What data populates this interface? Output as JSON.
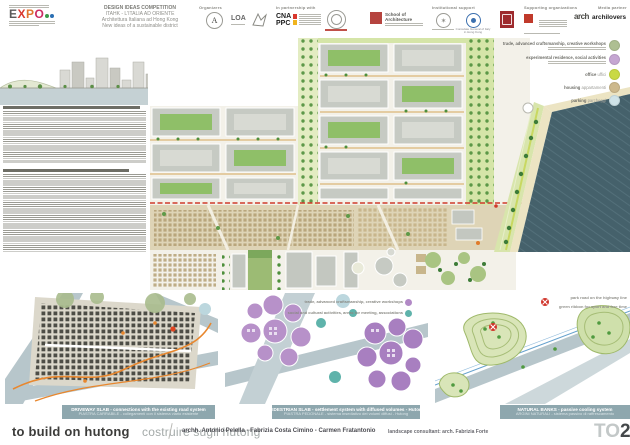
{
  "poster": {
    "header": {
      "expo_logo_text": "EXPO",
      "title_lines": [
        "DESIGN IDEAS COMPETITION",
        "ITAHK - L'ITALIA AD ORIENTE",
        "Architettura Italiana ad Hong Kong",
        "New ideas of a sustainable district"
      ],
      "organizers_label": "Organizers",
      "organizer_a": "A",
      "organizer_loa": "LOA",
      "partnership_label": "In partnership with",
      "cna_line1": "CNA",
      "cna_line2": "PPC",
      "school_logo": "School of Architecture",
      "institutional_label": "Institutional support",
      "consulate_caption_1": "Consulate General of Italy",
      "consulate_caption_2": "in Hong Kong",
      "supporting_label": "Supporting organizations",
      "arch_logo": "arch",
      "media_label": "Media partner",
      "media_logo": "archilovers"
    },
    "legend": {
      "items": [
        {
          "label": "trade, advanced craftsmanship, creative workshops",
          "color": "#aebf92"
        },
        {
          "label": "experimental residence, social activities",
          "color": "#c5a6d2"
        },
        {
          "label": "office",
          "sublabel": "uffici",
          "color": "#c9d944"
        },
        {
          "label": "housing",
          "sublabel": "appartamenti",
          "color": "#cdb98d"
        },
        {
          "label": "parking",
          "sublabel": "parcheggi",
          "color": "#cfe3e8"
        }
      ]
    },
    "diagram_legend": {
      "items": [
        {
          "label": "trade, advanced craftsmanship, creative workshops",
          "color": "#b289c6"
        },
        {
          "label": "social and cultural activities, areas for meeting, associations",
          "color": "#5fb3ab"
        }
      ]
    },
    "natural_banks_notes": {
      "note1": "park road on the highway line",
      "note2": "green ribbon for sport and free time"
    },
    "captions": [
      {
        "en": "DRIVEWAY SLAB - connections with the existing road system",
        "it": "PIASTRA CARRABILE - collegamenti con il sistema viario esistente"
      },
      {
        "en": "PEDESTRIAN SLAB - settlement system with diffused volumes - Hutong",
        "it": "PIASTRA PEDONALE - sistema insediativo dei volumi diffusi - Hutong"
      },
      {
        "en": "NATURAL BANKS - passive cooling system",
        "it": "ARGINI NATURALI - sistema passivo di raffrescamento"
      }
    ],
    "footer": {
      "title_en": "to build on hutong",
      "title_it": "costruire sugli hutong",
      "architects": "archh. Antonio Pelella - Fabrizia Costa Cimino - Carmen Fratantonio",
      "consultant": "landscape consultant: arch. Fabrizia Forte",
      "logo_to": "TO",
      "logo_2": "2"
    },
    "colors": {
      "water": "#45616b",
      "park_green": "#8fbf68",
      "tree_green": "#4e8f3c",
      "block_gray": "#c6cac3",
      "hutong_tan": "#ded4b6",
      "red_dashed_line": "#d03a2a",
      "caption_band": "#8ea7ae",
      "orange_accent": "#e8872e",
      "purple": "#b791c9",
      "teal": "#5fb3ab",
      "road_blue_gray": "#b7c6cb"
    }
  }
}
